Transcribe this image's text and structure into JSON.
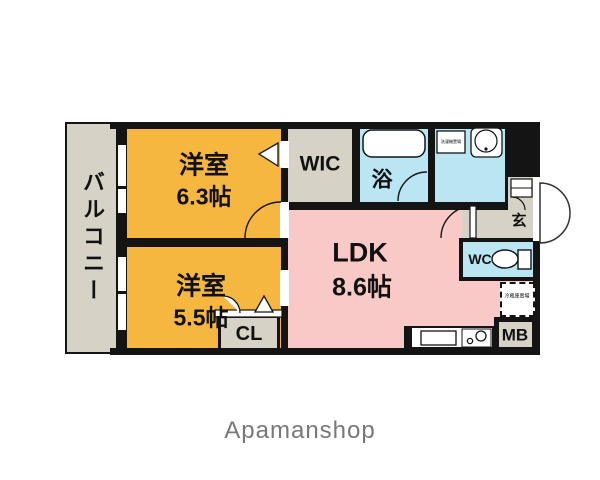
{
  "meta": {
    "type": "japanese-apartment-floor-plan"
  },
  "colors": {
    "room-orange": "#F6B740",
    "room-pink": "#F9C9C7",
    "room-blue": "#B9E6F2",
    "room-gray": "#D6D2C6",
    "wall": "#141414",
    "text": "#111111",
    "footer-text": "#787878"
  },
  "rooms": {
    "balcony": {
      "label": "バルコニー"
    },
    "bedroom1": {
      "type": "洋室",
      "size": "6.3帖"
    },
    "bedroom2": {
      "type": "洋室",
      "size": "5.5帖"
    },
    "ldk": {
      "type": "LDK",
      "size": "8.6帖"
    },
    "wic": {
      "label": "WIC"
    },
    "bath": {
      "label": "浴"
    },
    "closet": {
      "label": "CL"
    },
    "toilet": {
      "label": "WC"
    },
    "entrance": {
      "label": "玄"
    },
    "meter_box": {
      "label": "MB"
    },
    "fridge_space": {
      "label": "冷蔵庫置場"
    },
    "washer_space": {
      "label": "洗濯機置場"
    }
  },
  "footer": {
    "brand": "Apamanshop"
  }
}
